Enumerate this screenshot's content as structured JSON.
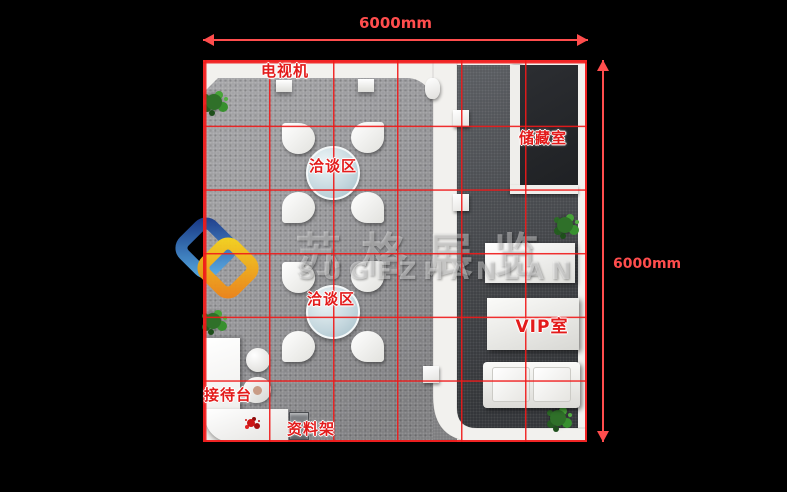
{
  "plan": {
    "dimensions": {
      "width_label": "6000mm",
      "height_label": "6000mm",
      "arrow_color": "#ff4d4d"
    },
    "grid": {
      "columns": 6,
      "rows": 6,
      "line_color": "#f01919"
    },
    "labels": {
      "tv": "电视机",
      "meeting_area_1": "洽谈区",
      "meeting_area_2": "洽谈区",
      "storage_room": "储藏室",
      "vip_room": "VIP室",
      "reception_desk": "接待台",
      "brochure_rack": "资料架"
    },
    "label_color": "#e31b1b",
    "floors": {
      "carpet": "#98989b",
      "vip_floor": "#45484d",
      "storage_floor": "#232529",
      "wall_white": "#f2f1ee",
      "background": "#000000"
    }
  },
  "watermark": {
    "cn_text": "苏格展览",
    "en_text": "SUGEZHANLAN",
    "logo_blue": "#2a6cc0",
    "logo_yellow": "#f6d11d",
    "logo_orange": "#ee8618"
  }
}
